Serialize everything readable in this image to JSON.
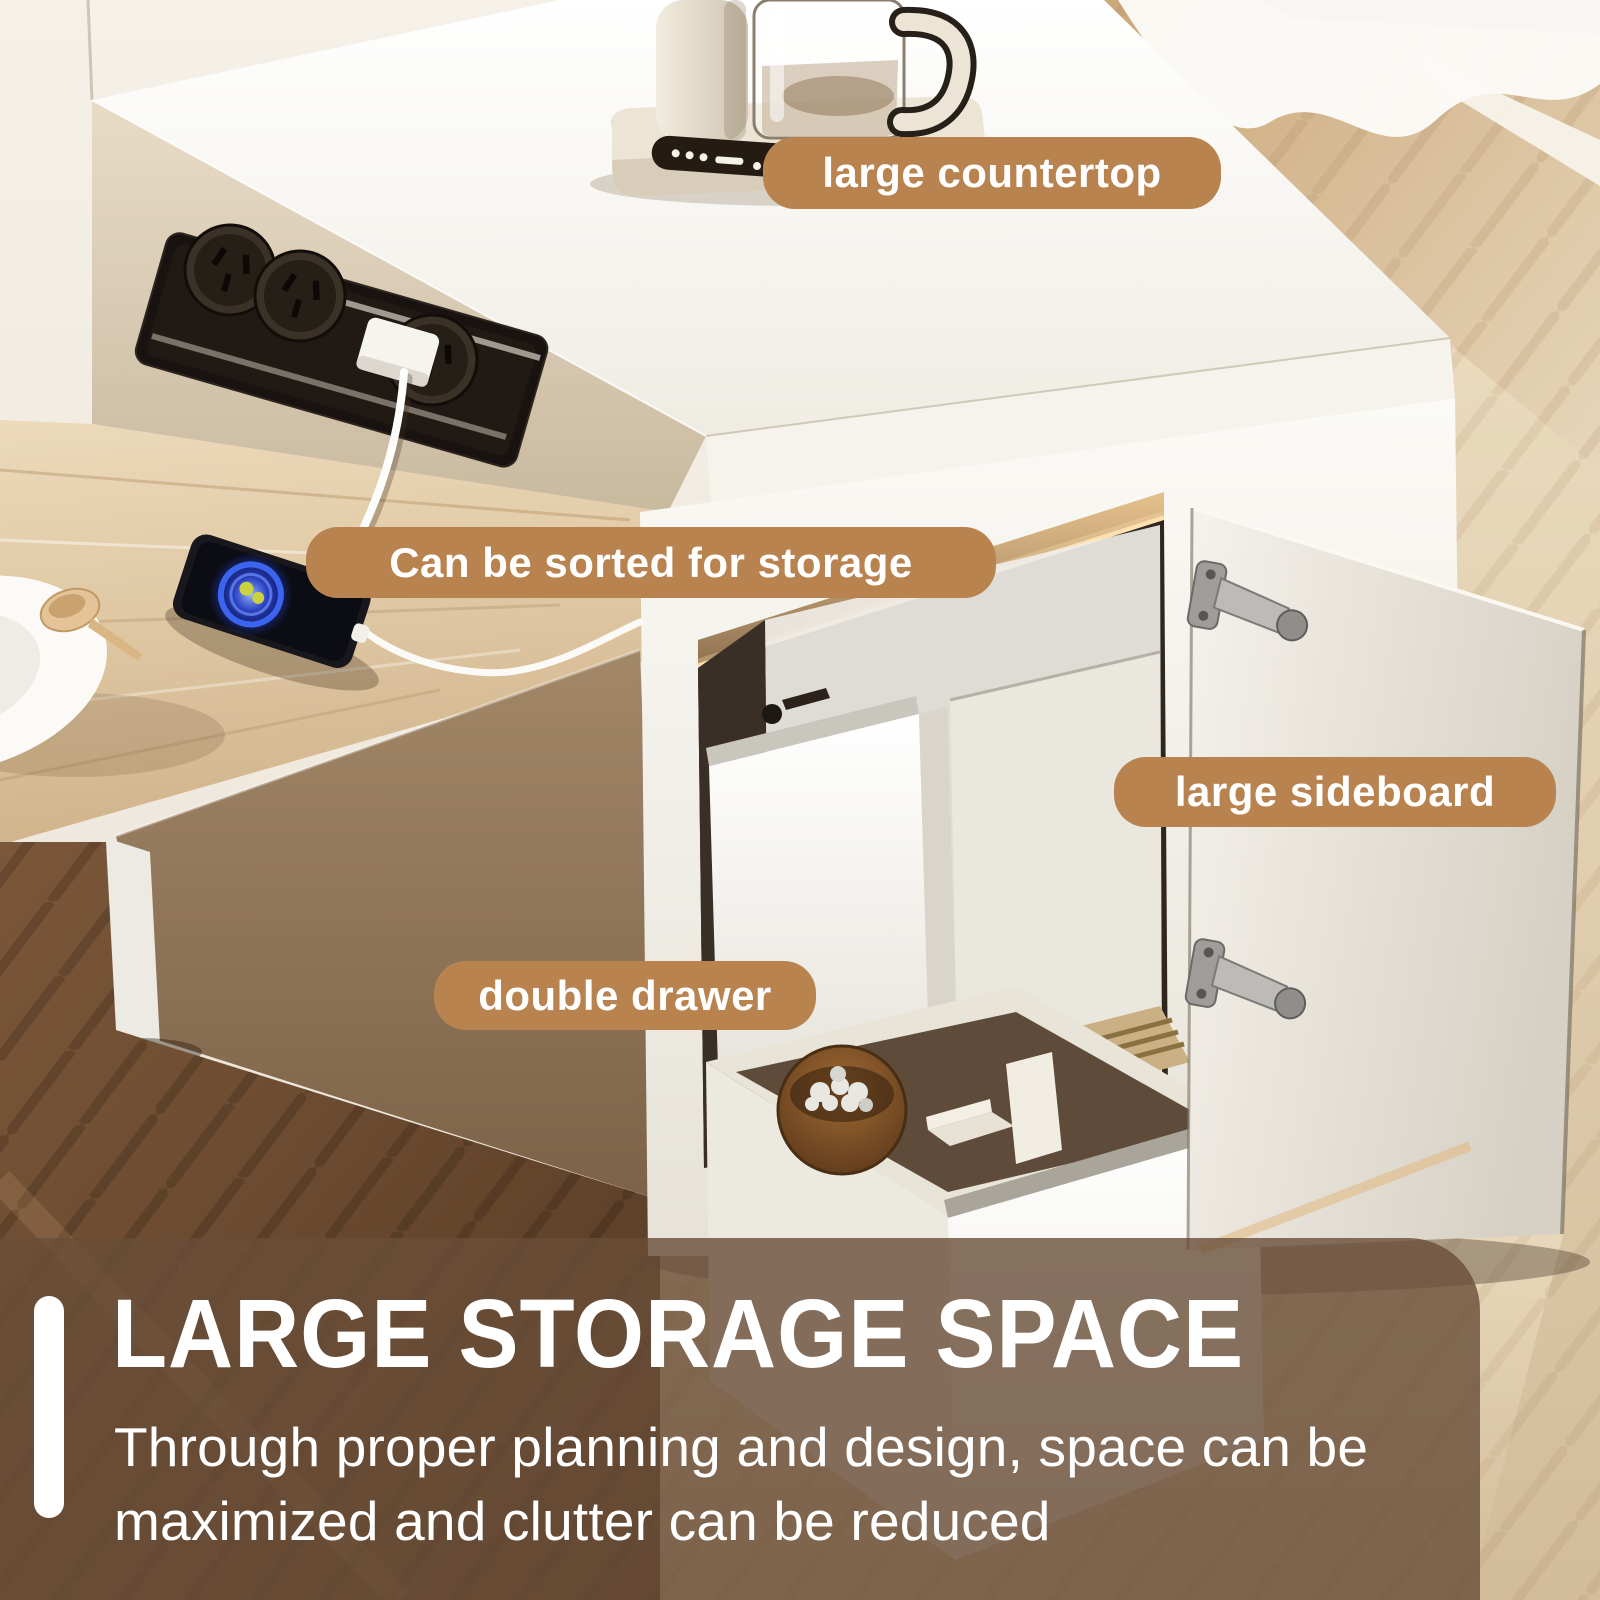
{
  "badges": [
    {
      "id": "large-countertop",
      "label": "large countertop"
    },
    {
      "id": "sorted-storage",
      "label": "Can be sorted for storage"
    },
    {
      "id": "large-sideboard",
      "label": "large sideboard"
    },
    {
      "id": "double-drawer",
      "label": "double drawer"
    }
  ],
  "footer": {
    "headline": "LARGE STORAGE SPACE",
    "subtitle": "Through proper planning and design, space can be\nmaximized and clutter can be reduced"
  },
  "colors": {
    "badge_bg": "#b9834f",
    "footer_overlay": "rgba(105,77,56,0.8)",
    "accent_bar": "#ffffff",
    "text_light": "#ffffff"
  }
}
